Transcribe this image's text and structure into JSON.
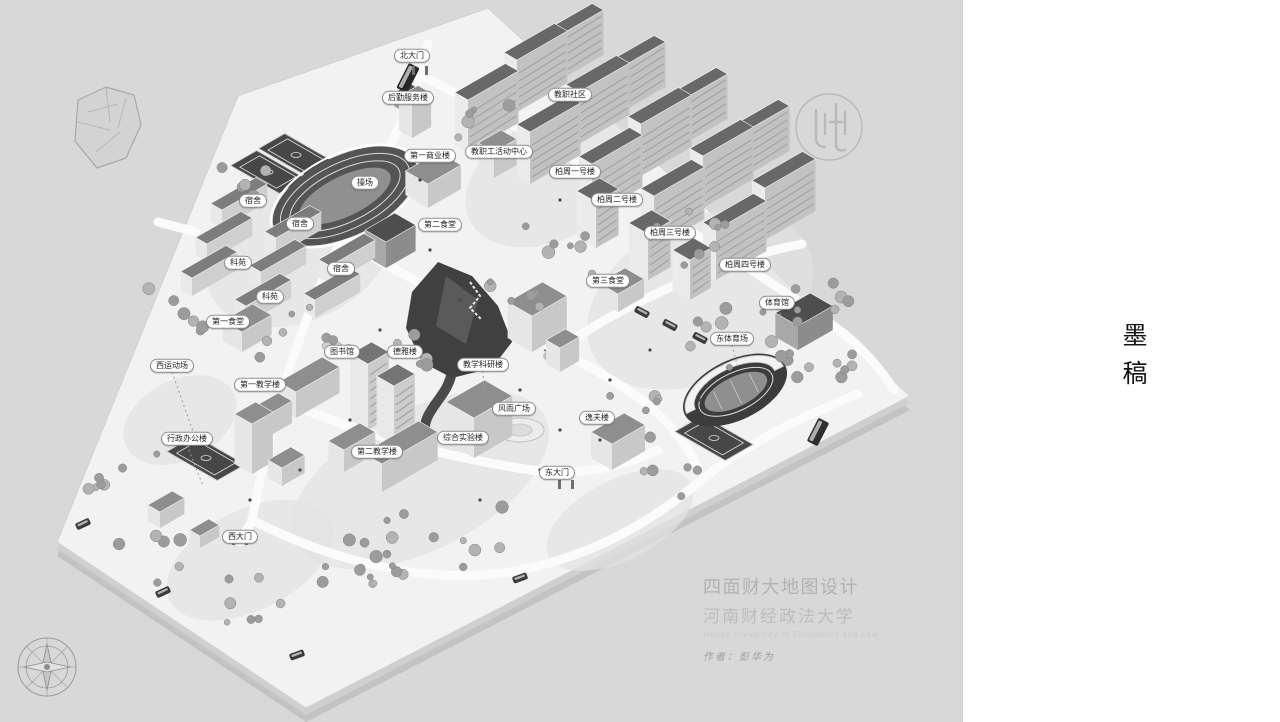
{
  "page": {
    "background": "#d8d8d8"
  },
  "side_panel": {
    "vertical_title": "墨稿",
    "background": "#ffffff"
  },
  "map": {
    "labels": [
      {
        "text": "北大门",
        "x": 412,
        "y": 56
      },
      {
        "text": "后勤服务楼",
        "x": 408,
        "y": 98
      },
      {
        "text": "教职社区",
        "x": 570,
        "y": 95
      },
      {
        "text": "教职工活动中心",
        "x": 499,
        "y": 152
      },
      {
        "text": "第一商业楼",
        "x": 430,
        "y": 156
      },
      {
        "text": "操场",
        "x": 365,
        "y": 183
      },
      {
        "text": "宿舍",
        "x": 253,
        "y": 201
      },
      {
        "text": "宿舍",
        "x": 300,
        "y": 224
      },
      {
        "text": "宿舍",
        "x": 341,
        "y": 269
      },
      {
        "text": "第二食堂",
        "x": 440,
        "y": 225
      },
      {
        "text": "柏周一号楼",
        "x": 575,
        "y": 172
      },
      {
        "text": "柏周二号楼",
        "x": 617,
        "y": 200
      },
      {
        "text": "柏周三号楼",
        "x": 670,
        "y": 233
      },
      {
        "text": "柏周四号楼",
        "x": 745,
        "y": 265
      },
      {
        "text": "第三食堂",
        "x": 608,
        "y": 281
      },
      {
        "text": "体育馆",
        "x": 777,
        "y": 303,
        "lx": 790,
        "ly": 330
      },
      {
        "text": "东体育场",
        "x": 732,
        "y": 339,
        "lx": 738,
        "ly": 368
      },
      {
        "text": "科苑",
        "x": 238,
        "y": 263
      },
      {
        "text": "科苑",
        "x": 270,
        "y": 297
      },
      {
        "text": "第一食堂",
        "x": 228,
        "y": 322
      },
      {
        "text": "图书馆",
        "x": 342,
        "y": 352
      },
      {
        "text": "德雅楼",
        "x": 405,
        "y": 352
      },
      {
        "text": "第一教学楼",
        "x": 260,
        "y": 385
      },
      {
        "text": "教学科研楼",
        "x": 483,
        "y": 365,
        "lx": 484,
        "ly": 392
      },
      {
        "text": "风雨广场",
        "x": 514,
        "y": 409
      },
      {
        "text": "综合实验楼",
        "x": 463,
        "y": 438
      },
      {
        "text": "第二教学楼",
        "x": 377,
        "y": 452
      },
      {
        "text": "行政办公楼",
        "x": 187,
        "y": 439,
        "lx": 203,
        "ly": 486
      },
      {
        "text": "西运动场",
        "x": 172,
        "y": 366,
        "lx": 196,
        "ly": 440
      },
      {
        "text": "西大门",
        "x": 240,
        "y": 537
      },
      {
        "text": "东大门",
        "x": 557,
        "y": 473
      },
      {
        "text": "逸夫楼",
        "x": 597,
        "y": 418
      }
    ],
    "signature": {
      "artistic_title": "四面财大地图设计",
      "university_cn": "河南财经政法大学",
      "university_en": "Henan University of Economics and Law",
      "author_line": "作者：彭华为"
    }
  }
}
